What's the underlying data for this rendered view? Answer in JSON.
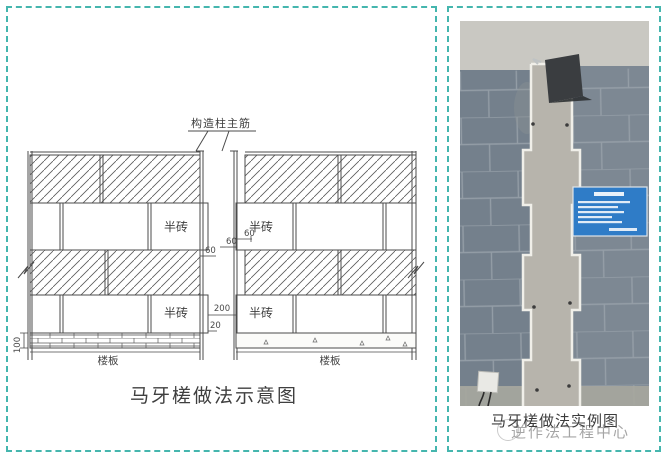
{
  "page": {
    "background": "#ffffff",
    "border_color": "#45b6ae"
  },
  "left_panel": {
    "title": "马牙槎做法示意图",
    "labels": {
      "rebar_callout": "构造柱主筋",
      "half_brick": "半砖",
      "floor_slab_left": "楼板",
      "floor_slab_right": "楼板"
    },
    "dimensions": {
      "tooth_depth_a": "60",
      "tooth_depth_b": "60",
      "tooth_depth_c": "60",
      "column_width": "200",
      "tooth_offset": "20",
      "slab_thickness": "100"
    }
  },
  "right_panel": {
    "caption": "马牙槎做法实例图",
    "watermark": "逆作法工程中心",
    "photo_colors": {
      "beam": "#c9c8c2",
      "wall_left": "#74808c",
      "wall_right": "#7d8893",
      "joint": "#99a2ab",
      "column": "#b7b4ac",
      "tooth_outline": "#f0efe9",
      "funnel": "#3a3d40",
      "sign": "#2f7cc7",
      "base_strip": "#a7a79f"
    }
  }
}
